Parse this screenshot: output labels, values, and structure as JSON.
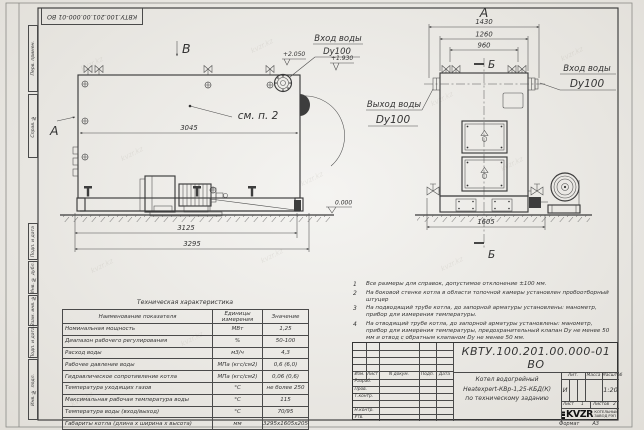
{
  "watermark": {
    "text": "kvzr.kz"
  },
  "frame": {
    "top_stamp": "КВТУ.100.201.00.000-01 ВО",
    "sidebar": {
      "perv": "Перв. примен.",
      "sprav": "Справ. №",
      "podp1": "Подп. и дата",
      "inv_dubl": "Инв. № дубл.",
      "vzam": "Взам. инв. №",
      "podp2": "Подп. и дата",
      "inv_podl": "Инв. № подл."
    },
    "format_label": "Формат",
    "format_value": "А3"
  },
  "side_view": {
    "view_b": "В",
    "view_a": "А",
    "see_note": "см. п. 2",
    "inlet_line1": "Вход воды",
    "inlet_line2": "Dy100",
    "elev1": "+2.050",
    "elev2": "+1.930",
    "elev_zero": "0.000",
    "dim_3045": "3045",
    "dim_3125": "3125",
    "dim_3295": "3295"
  },
  "front_view": {
    "title": "А",
    "sec_top": "Б",
    "sec_bottom": "Б",
    "dim_1430": "1430",
    "dim_1260": "1260",
    "dim_960": "960",
    "dim_1605": "1605",
    "inlet_line1": "Вход воды",
    "inlet_line2": "Dy100",
    "outlet_line1": "Выход воды",
    "outlet_line2": "Dy100"
  },
  "notes": [
    {
      "num": "1",
      "text": "Все размеры для справок, допустимое отклонение ±100 мм."
    },
    {
      "num": "2",
      "text": "На боковой стенке котла в области топочной камеры установлен пробоотборный штуцер"
    },
    {
      "num": "3",
      "text": "На  подводящий трубе котла, до запорной арматуры установлены: манометр, прибор для измерения температуры."
    },
    {
      "num": "4",
      "text": "На отводящий трубе котла, до запорной арматуры установлены: манометр, прибор для измерения температуры, предохранительный клапан Dу не менее 50 мм и отвод с обратным клапаном Dу не менее 50 мм."
    }
  ],
  "spec_table": {
    "title": "Техническая характеристика",
    "headers": {
      "name": "Наименование показателя",
      "units": "Единицы измерения",
      "value": "Значение"
    },
    "rows": [
      {
        "name": "Номинальная мощность",
        "units": "МВт",
        "value": "1,25"
      },
      {
        "name": "Диапазон рабочего регулирования",
        "units": "%",
        "value": "50-100"
      },
      {
        "name": "Расход воды",
        "units": "м3/ч",
        "value": "4,3"
      },
      {
        "name": "Рабочее давление воды",
        "units": "МПа (кгс/см2)",
        "value": "0,6 (6,0)"
      },
      {
        "name": "Гидравлическое сопротивление котла",
        "units": "МПа (кгс/см2)",
        "value": "0,06 (0,6)"
      },
      {
        "name": "Температура уходящих газов",
        "units": "°С",
        "value": "не более 250"
      },
      {
        "name": "Максимальная рабочая температура воды",
        "units": "°С",
        "value": "115"
      },
      {
        "name": "Температура воды (вход/выход)",
        "units": "°С",
        "value": "70/95"
      },
      {
        "name": "Габариты котла (длина х ширина х высота)",
        "units": "мм",
        "value": "3295х1605х2050"
      }
    ]
  },
  "title_block": {
    "doc_number": "КВТУ.100.201.00.000-01 ВО",
    "cols": {
      "izm": "Изм.",
      "list": "Лист",
      "docum": "N докум.",
      "podp": "Подп.",
      "data": "Дата"
    },
    "rows": {
      "razrab": "Разраб.",
      "prov": "Пров.",
      "tkontr": "Т.контр.",
      "nkontr": "Н.контр.",
      "utv": "Утв."
    },
    "name_line1": "Котел водогрейный",
    "name_line2": "Heatexpert-КВр-1,25-КБД(К)",
    "name_line3": "по техническому заданию",
    "lit_label": "Лит.",
    "lit_value": "И",
    "mass_label": "Масса",
    "scale_label": "Масштаб",
    "scale_value": "1:20",
    "sheet_label": "Лист",
    "sheet_value": "1",
    "sheets_label": "Листов",
    "sheets_value": "2",
    "logo_text": "KVZR",
    "logo_sub1": "КОТЕЛЬНЫЙ",
    "logo_sub2": "ЗАВОД РЭП"
  }
}
